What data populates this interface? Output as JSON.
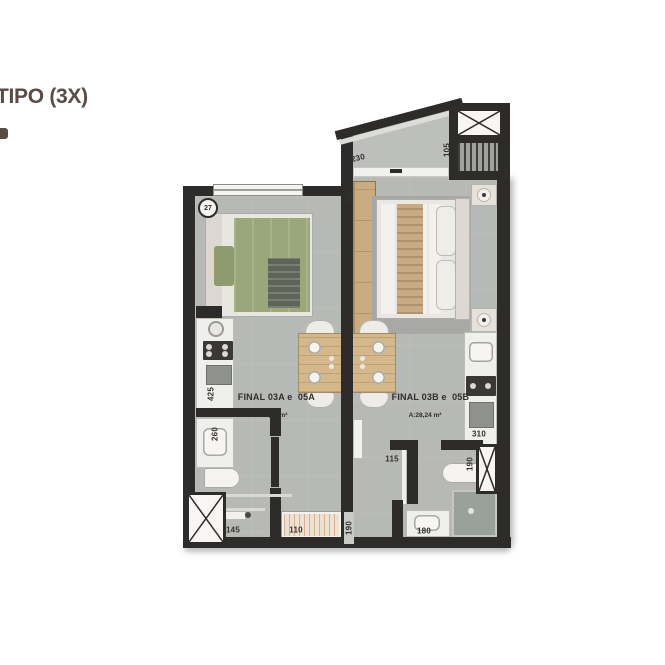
{
  "title": "TIPO (3X)",
  "plan": {
    "marker": "27",
    "units": {
      "a": {
        "name": "FINAL 03A e  05A",
        "area": "A:21,58 m²"
      },
      "b": {
        "name": "FINAL 03B e  05B",
        "area": "A:28,24 m²"
      }
    },
    "dims": {
      "balcony_width": "230",
      "balcony_depth": "105",
      "wardrobe": "555",
      "kitchen_a": "425",
      "bath_a": "260",
      "entry_a": "145",
      "shower_a": "110",
      "corridor": "190",
      "hall_b": "115",
      "toilet_b": "190",
      "vanity_b": "180",
      "kitchen_b": "310"
    },
    "colors": {
      "wall": "#2e2c2a",
      "floor": "#b7b9b6",
      "bed_green": "#9aa77a",
      "wood": "#d4b88c",
      "title_brown": "#5a4b44"
    }
  }
}
